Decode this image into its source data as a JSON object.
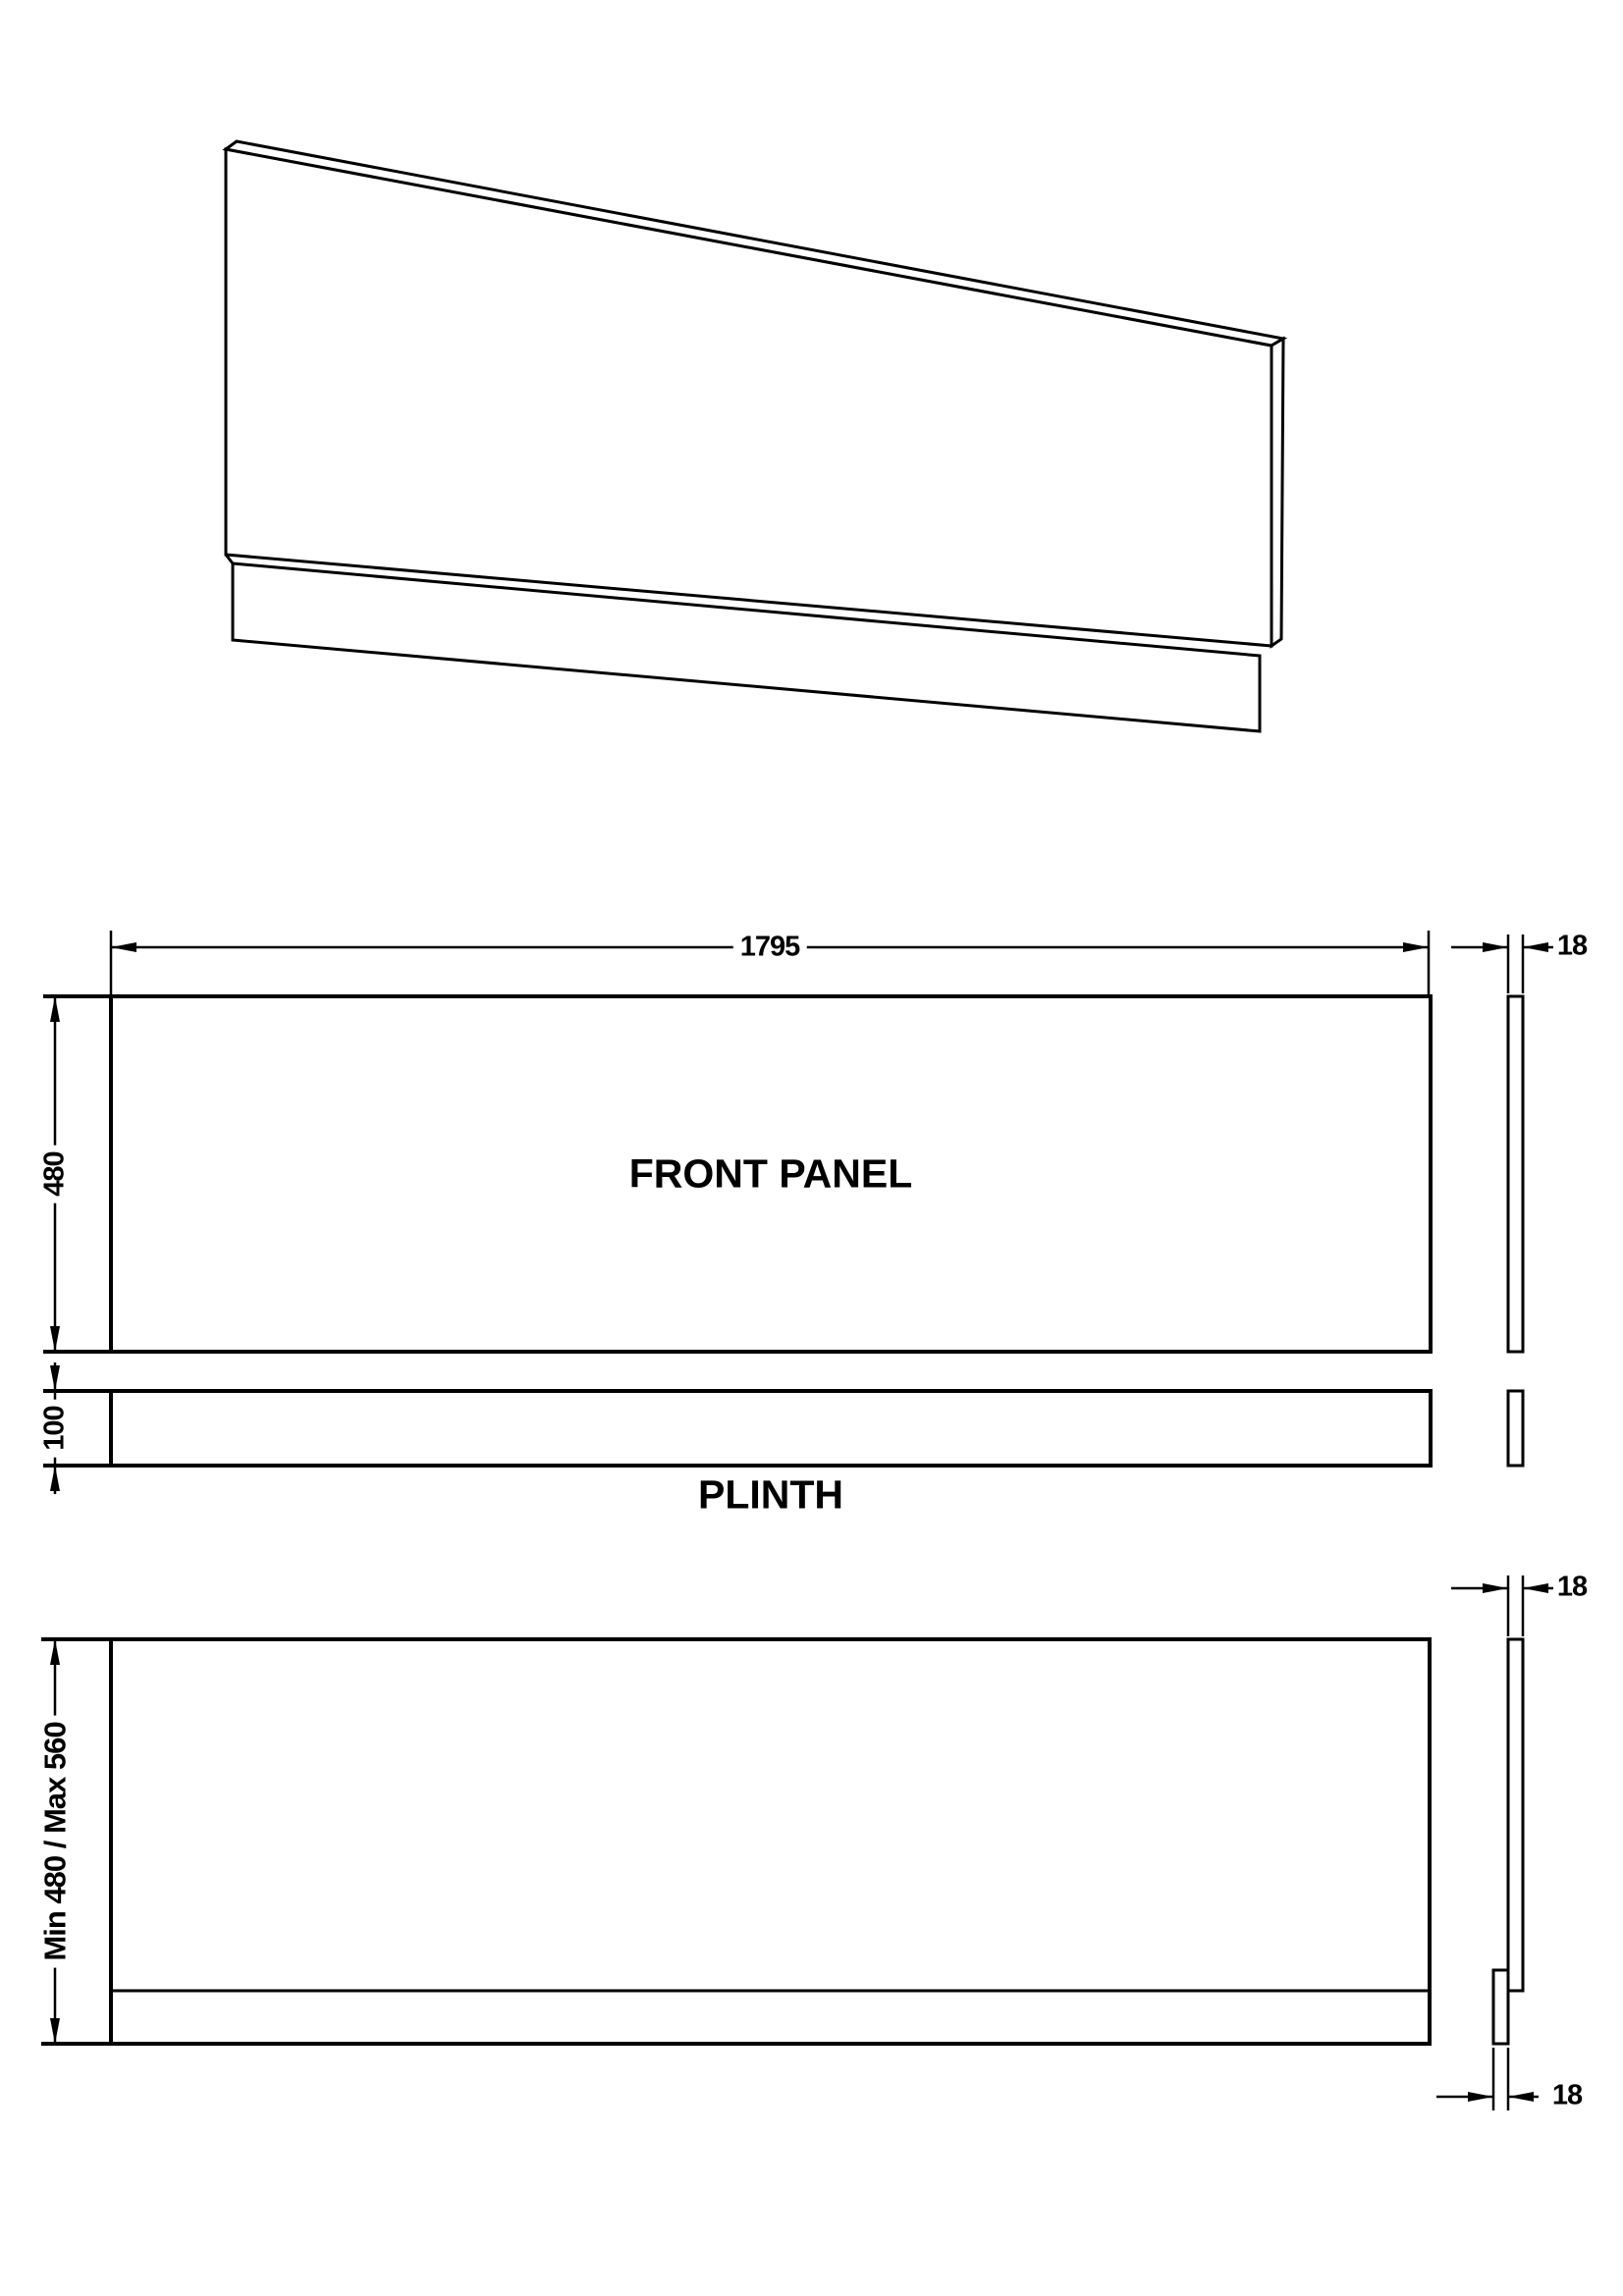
{
  "drawing": {
    "perspective": {
      "name": "panel-perspective-view"
    },
    "front_view": {
      "label": "FRONT PANEL",
      "width_dim": "1795",
      "height_dim": "480",
      "thickness_dim": "18"
    },
    "plinth_view": {
      "label": "PLINTH",
      "height_dim": "100"
    },
    "combined_view": {
      "height_dim": "Min 480 / Max 560",
      "thickness_dim_top": "18",
      "thickness_dim_bottom": "18"
    },
    "colors": {
      "line": "#000000",
      "background": "#ffffff"
    }
  }
}
